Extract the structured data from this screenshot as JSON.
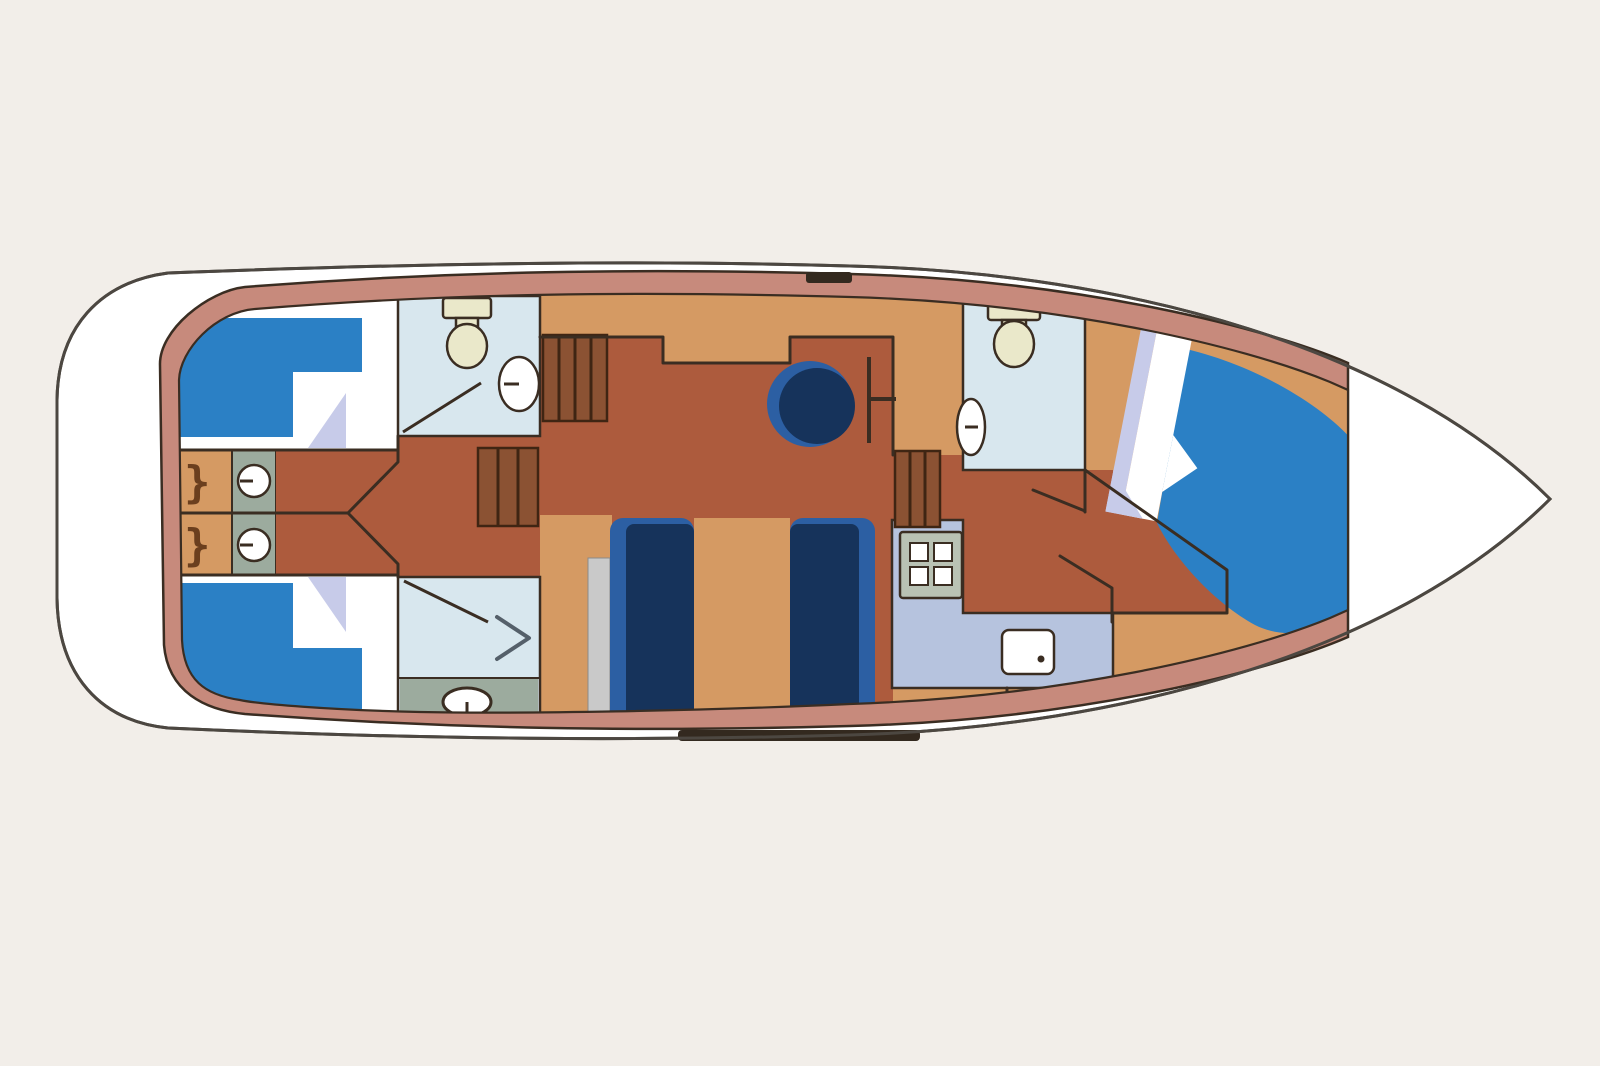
{
  "scene": {
    "type": "boat-deck-plan",
    "view": "top-down",
    "orientation": "bow-right"
  },
  "colors": {
    "background": "#f2eee9",
    "deck-white": "#ffffff",
    "hull-outline": "#4c4741",
    "hull-band": "#c78a7c",
    "cleat-dark": "#33291f",
    "floor-tan": "#d59a63",
    "floor-dark": "#ad5b3d",
    "wall-line": "#3a2d22",
    "cabin-floor": "#ffffff",
    "bed-blue": "#2b80c5",
    "blanket-lavender": "#c7cbe9",
    "bench-navy": "#16335b",
    "bench-navy-light": "#2c5fa3",
    "bathroom-blue": "#d8e7ee",
    "shower-gray": "#9cab9e",
    "counter-gray": "#9cab9e",
    "strip-gray": "#c9c9c9",
    "galley-periwinkle": "#b6c3de",
    "stove-frame": "#b9c2b4",
    "fixture-cream": "#eae8ca",
    "fixture-white": "#ffffff",
    "stairs-brown": "#8b5233",
    "stairs-line": "#3f2513",
    "arrow-gray": "#55606a"
  },
  "glyphs": {
    "wardrobe_top": "}",
    "wardrobe_bottom": "}",
    "shower_arrow": ">"
  },
  "rooms": [
    {
      "name": "aft-cabin-top",
      "feature": "single-bed"
    },
    {
      "name": "aft-cabin-bottom",
      "feature": "single-bed"
    },
    {
      "name": "washroom-aft",
      "feature": "toilet-and-sink"
    },
    {
      "name": "shower-room-aft",
      "feature": "shower-and-toilet"
    },
    {
      "name": "corridor",
      "feature": "angled-walls"
    },
    {
      "name": "salon",
      "feature": "helm-seat"
    },
    {
      "name": "dinette",
      "feature": "two-benches-table"
    },
    {
      "name": "galley",
      "feature": "stove-and-sink"
    },
    {
      "name": "washroom-forward",
      "feature": "toilet-and-sink"
    },
    {
      "name": "bow-cabin",
      "feature": "diagonal-double-bed"
    }
  ]
}
